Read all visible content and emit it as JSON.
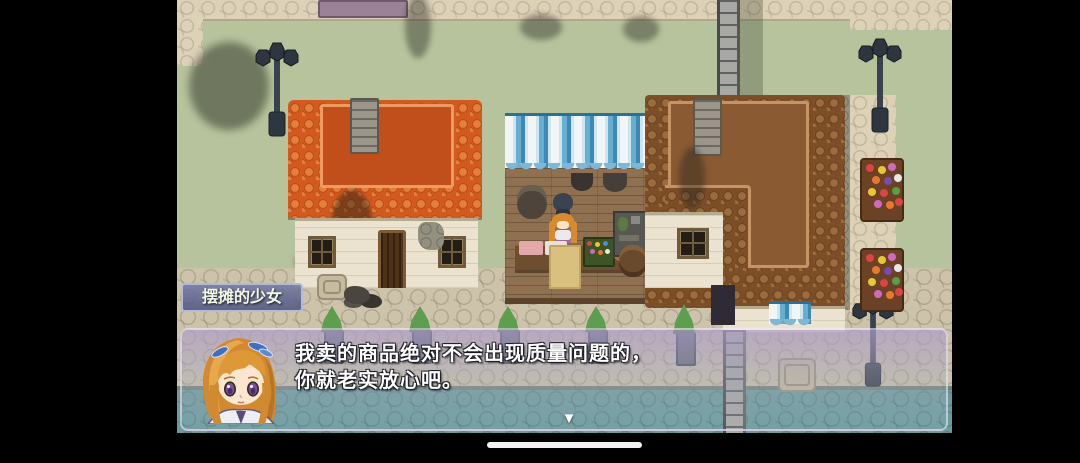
{
  "dialog": {
    "speaker": "摆摊的少女",
    "lines": [
      "我卖的商品绝对不会出现质量问题的，",
      "你就老实放心吧。"
    ],
    "continue_indicator": "▼"
  },
  "map_objects": {
    "buildings": [
      "orange-roof-house",
      "market-stall",
      "brown-roof-house"
    ],
    "props": [
      "street-lamp",
      "flower-stand",
      "hedge-post",
      "stone-pipe",
      "rubble-pile",
      "stone-plate"
    ]
  },
  "colors": {
    "awning_blue": "#66aed2",
    "roof_orange": "#d2591f",
    "roof_brown": "#7d4f28",
    "grass_green": "#b6c39c",
    "path_beige": "#ddd2b7",
    "street_grey": "#cdc3ab",
    "water_teal": "#6b9b9d",
    "window_tint": "#ae9ec8",
    "nametag_blue": "#5c64a0"
  }
}
